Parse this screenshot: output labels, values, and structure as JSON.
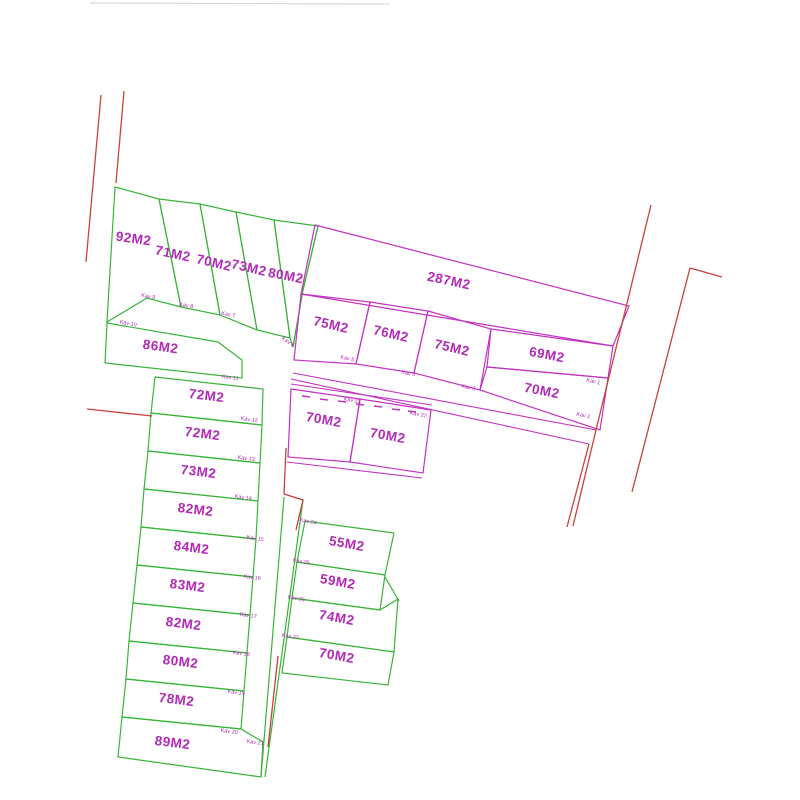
{
  "canvas": {
    "width": 800,
    "height": 800,
    "background": "#ffffff"
  },
  "colors": {
    "plot_green": "#38b438",
    "plot_magenta": "#c233c2",
    "boundary_red": "#c8423a",
    "label_magenta": "#b32ab8",
    "faint_gray": "#d9d9d9"
  },
  "plan": {
    "plots": [
      {
        "id": "plot-92m2",
        "color": "green",
        "points": "115,187 159,199 181,307 147,298 107,322",
        "label": "92M2",
        "lx": 133,
        "ly": 243,
        "rot": 8
      },
      {
        "id": "plot-71m2",
        "color": "green",
        "points": "159,199 200,204 220,315 181,307",
        "label": "71M2",
        "lx": 172,
        "ly": 258,
        "rot": 12
      },
      {
        "id": "plot-70m2-a",
        "color": "green",
        "points": "200,204 236,212 257,330 220,315",
        "label": "70M2",
        "lx": 213,
        "ly": 267,
        "rot": 13
      },
      {
        "id": "plot-73m2-a",
        "color": "green",
        "points": "236,212 274,220 290,338 257,330",
        "label": "73M2",
        "lx": 248,
        "ly": 272,
        "rot": 13
      },
      {
        "id": "plot-80m2-a",
        "color": "green",
        "points": "274,220 318,226 303,290 293,347 290,338",
        "label": "80M2",
        "lx": 285,
        "ly": 280,
        "rot": 11
      },
      {
        "id": "plot-86m2",
        "color": "green",
        "points": "107,323 218,342 242,360 242,378 105,363",
        "label": "86M2",
        "lx": 160,
        "ly": 351,
        "rot": 8
      },
      {
        "id": "plot-72m2-a",
        "color": "green",
        "points": "155,377 263,389 262,425 151,413",
        "label": "72M2",
        "lx": 206,
        "ly": 400,
        "rot": 7
      },
      {
        "id": "plot-72m2-b",
        "color": "green",
        "points": "151,413 262,425 260,463 148,451",
        "label": "72M2",
        "lx": 202,
        "ly": 438,
        "rot": 7
      },
      {
        "id": "plot-73m2-b",
        "color": "green",
        "points": "148,451 260,463 258,501 144,489",
        "label": "73M2",
        "lx": 198,
        "ly": 476,
        "rot": 7
      },
      {
        "id": "plot-82m2-a",
        "color": "green",
        "points": "144,489 258,501 256,539 141,527",
        "label": "82M2",
        "lx": 195,
        "ly": 514,
        "rot": 7
      },
      {
        "id": "plot-84m2",
        "color": "green",
        "points": "141,527 256,539 253,577 137,565",
        "label": "84M2",
        "lx": 191,
        "ly": 552,
        "rot": 7
      },
      {
        "id": "plot-83m2",
        "color": "green",
        "points": "137,565 253,577 250,615 133,603",
        "label": "83M2",
        "lx": 187,
        "ly": 590,
        "rot": 7
      },
      {
        "id": "plot-82m2-b",
        "color": "green",
        "points": "133,603 250,615 247,653 129,641",
        "label": "82M2",
        "lx": 183,
        "ly": 628,
        "rot": 7
      },
      {
        "id": "plot-80m2-b",
        "color": "green",
        "points": "129,641 247,653 244,691 126,679",
        "label": "80M2",
        "lx": 180,
        "ly": 666,
        "rot": 7
      },
      {
        "id": "plot-78m2",
        "color": "green",
        "points": "126,679 244,691 241,729 122,717",
        "label": "78M2",
        "lx": 176,
        "ly": 704,
        "rot": 7
      },
      {
        "id": "plot-89m2",
        "color": "green",
        "points": "122,717 241,729 263,742 261,777 118,757",
        "label": "89M2",
        "lx": 172,
        "ly": 747,
        "rot": 7
      },
      {
        "id": "plot-55m2",
        "color": "green",
        "points": "305,521 394,533 385,575 297,562",
        "label": "55M2",
        "lx": 346,
        "ly": 548,
        "rot": 10
      },
      {
        "id": "plot-59m2",
        "color": "green",
        "points": "297,562 385,575 380,610 292,598",
        "label": "59M2",
        "lx": 337,
        "ly": 586,
        "rot": 10
      },
      {
        "id": "plot-74m2",
        "color": "green",
        "points": "292,598 380,610 398,599 394,652 287,637",
        "label": "74M2",
        "lx": 336,
        "ly": 622,
        "rot": 10
      },
      {
        "id": "plot-70m2-b",
        "color": "green",
        "points": "287,637 394,652 388,685 282,673",
        "label": "70M2",
        "lx": 336,
        "ly": 660,
        "rot": 10
      },
      {
        "id": "plot-70m2-c",
        "color": "magenta",
        "points": "291,389 360,399 350,462 288,457",
        "label": "70M2",
        "lx": 323,
        "ly": 424,
        "rot": 10
      },
      {
        "id": "plot-70m2-d",
        "color": "magenta",
        "points": "360,399 431,410 423,473 350,462",
        "label": "70M2",
        "lx": 387,
        "ly": 440,
        "rot": 10
      },
      {
        "id": "plot-287m2",
        "color": "magenta",
        "points": "315,225 629,306 613,346 301,294",
        "label": "287M2",
        "lx": 448,
        "ly": 285,
        "rot": 12
      },
      {
        "id": "plot-75m2-a",
        "color": "magenta",
        "points": "301,294 370,302 356,364 294,360",
        "label": "75M2",
        "lx": 330,
        "ly": 329,
        "rot": 13
      },
      {
        "id": "plot-76m2",
        "color": "magenta",
        "points": "370,302 428,311 414,373 356,364",
        "label": "76M2",
        "lx": 390,
        "ly": 338,
        "rot": 13
      },
      {
        "id": "plot-75m2-b",
        "color": "magenta",
        "points": "428,311 491,329 480,390 414,373",
        "label": "75M2",
        "lx": 451,
        "ly": 352,
        "rot": 13
      },
      {
        "id": "plot-69m2",
        "color": "magenta",
        "points": "491,329 613,346 608,378 487,367",
        "label": "69M2",
        "lx": 546,
        "ly": 359,
        "rot": 11
      },
      {
        "id": "plot-70m2-e",
        "color": "magenta",
        "points": "487,367 608,378 600,430 480,390",
        "label": "70M2",
        "lx": 541,
        "ly": 395,
        "rot": 11
      }
    ],
    "kav_labels": [
      {
        "text": "Kav 9",
        "x": 148,
        "y": 298,
        "rot": 10
      },
      {
        "text": "Kav 8",
        "x": 186,
        "y": 307,
        "rot": 10
      },
      {
        "text": "Kav 7",
        "x": 228,
        "y": 316,
        "rot": 10
      },
      {
        "text": "Kav 6",
        "x": 287,
        "y": 343,
        "rot": 35
      },
      {
        "text": "Kav 10",
        "x": 128,
        "y": 325,
        "rot": 10
      },
      {
        "text": "Kav 11",
        "x": 230,
        "y": 379,
        "rot": 8
      },
      {
        "text": "Kav 12",
        "x": 249,
        "y": 421,
        "rot": 8
      },
      {
        "text": "Kav 13",
        "x": 246,
        "y": 460,
        "rot": 8
      },
      {
        "text": "Kav 14",
        "x": 243,
        "y": 499,
        "rot": 8
      },
      {
        "text": "Kav 15",
        "x": 255,
        "y": 540,
        "rot": 8
      },
      {
        "text": "Kav 16",
        "x": 252,
        "y": 579,
        "rot": 8
      },
      {
        "text": "Kav 17",
        "x": 248,
        "y": 617,
        "rot": 8
      },
      {
        "text": "Kav 18",
        "x": 241,
        "y": 655,
        "rot": 8
      },
      {
        "text": "Kav 19",
        "x": 236,
        "y": 694,
        "rot": 8
      },
      {
        "text": "Kav 20",
        "x": 229,
        "y": 733,
        "rot": 8
      },
      {
        "text": "Kav 21",
        "x": 255,
        "y": 744,
        "rot": 8
      },
      {
        "text": "Kav 5",
        "x": 347,
        "y": 360,
        "rot": 12
      },
      {
        "text": "Kav 4",
        "x": 408,
        "y": 375,
        "rot": 12
      },
      {
        "text": "Kav 3",
        "x": 468,
        "y": 389,
        "rot": 12
      },
      {
        "text": "Kav 1",
        "x": 593,
        "y": 383,
        "rot": 12
      },
      {
        "text": "Kav 2",
        "x": 583,
        "y": 417,
        "rot": 12
      },
      {
        "text": "Kav 23",
        "x": 352,
        "y": 402,
        "rot": 10
      },
      {
        "text": "Kav 22",
        "x": 418,
        "y": 416,
        "rot": 10
      },
      {
        "text": "Kav 24",
        "x": 308,
        "y": 523,
        "rot": 10
      },
      {
        "text": "Kav 25",
        "x": 301,
        "y": 563,
        "rot": 10
      },
      {
        "text": "Kav 26",
        "x": 296,
        "y": 600,
        "rot": 10
      },
      {
        "text": "Kav 27",
        "x": 290,
        "y": 638,
        "rot": 10
      }
    ],
    "lines": {
      "red": [
        "101,95 86,262",
        "124,91 116,183",
        "87,409 152,416",
        "651,205 596,430 573,526",
        "690,268 632,492",
        "690,268 722,277",
        "589,444 567,527",
        "286,448 284,494 303,500 296,530",
        "278,656 268,747"
      ],
      "magenta": [
        "293,373 596,430",
        "291,379 589,444",
        "291,384 432,405",
        "287,462 422,478"
      ],
      "green": [
        "318,226 303,290 293,347",
        "284,497 261,777",
        "303,500 265,777",
        "385,577 399,601"
      ],
      "gray": [
        "90,3 390,4"
      ]
    },
    "dashes": [
      "302,396 310,397",
      "320,399 328,400",
      "338,401 346,402",
      "356,404 364,405",
      "374,406 382,407",
      "392,409 400,410",
      "408,411 416,412"
    ]
  }
}
